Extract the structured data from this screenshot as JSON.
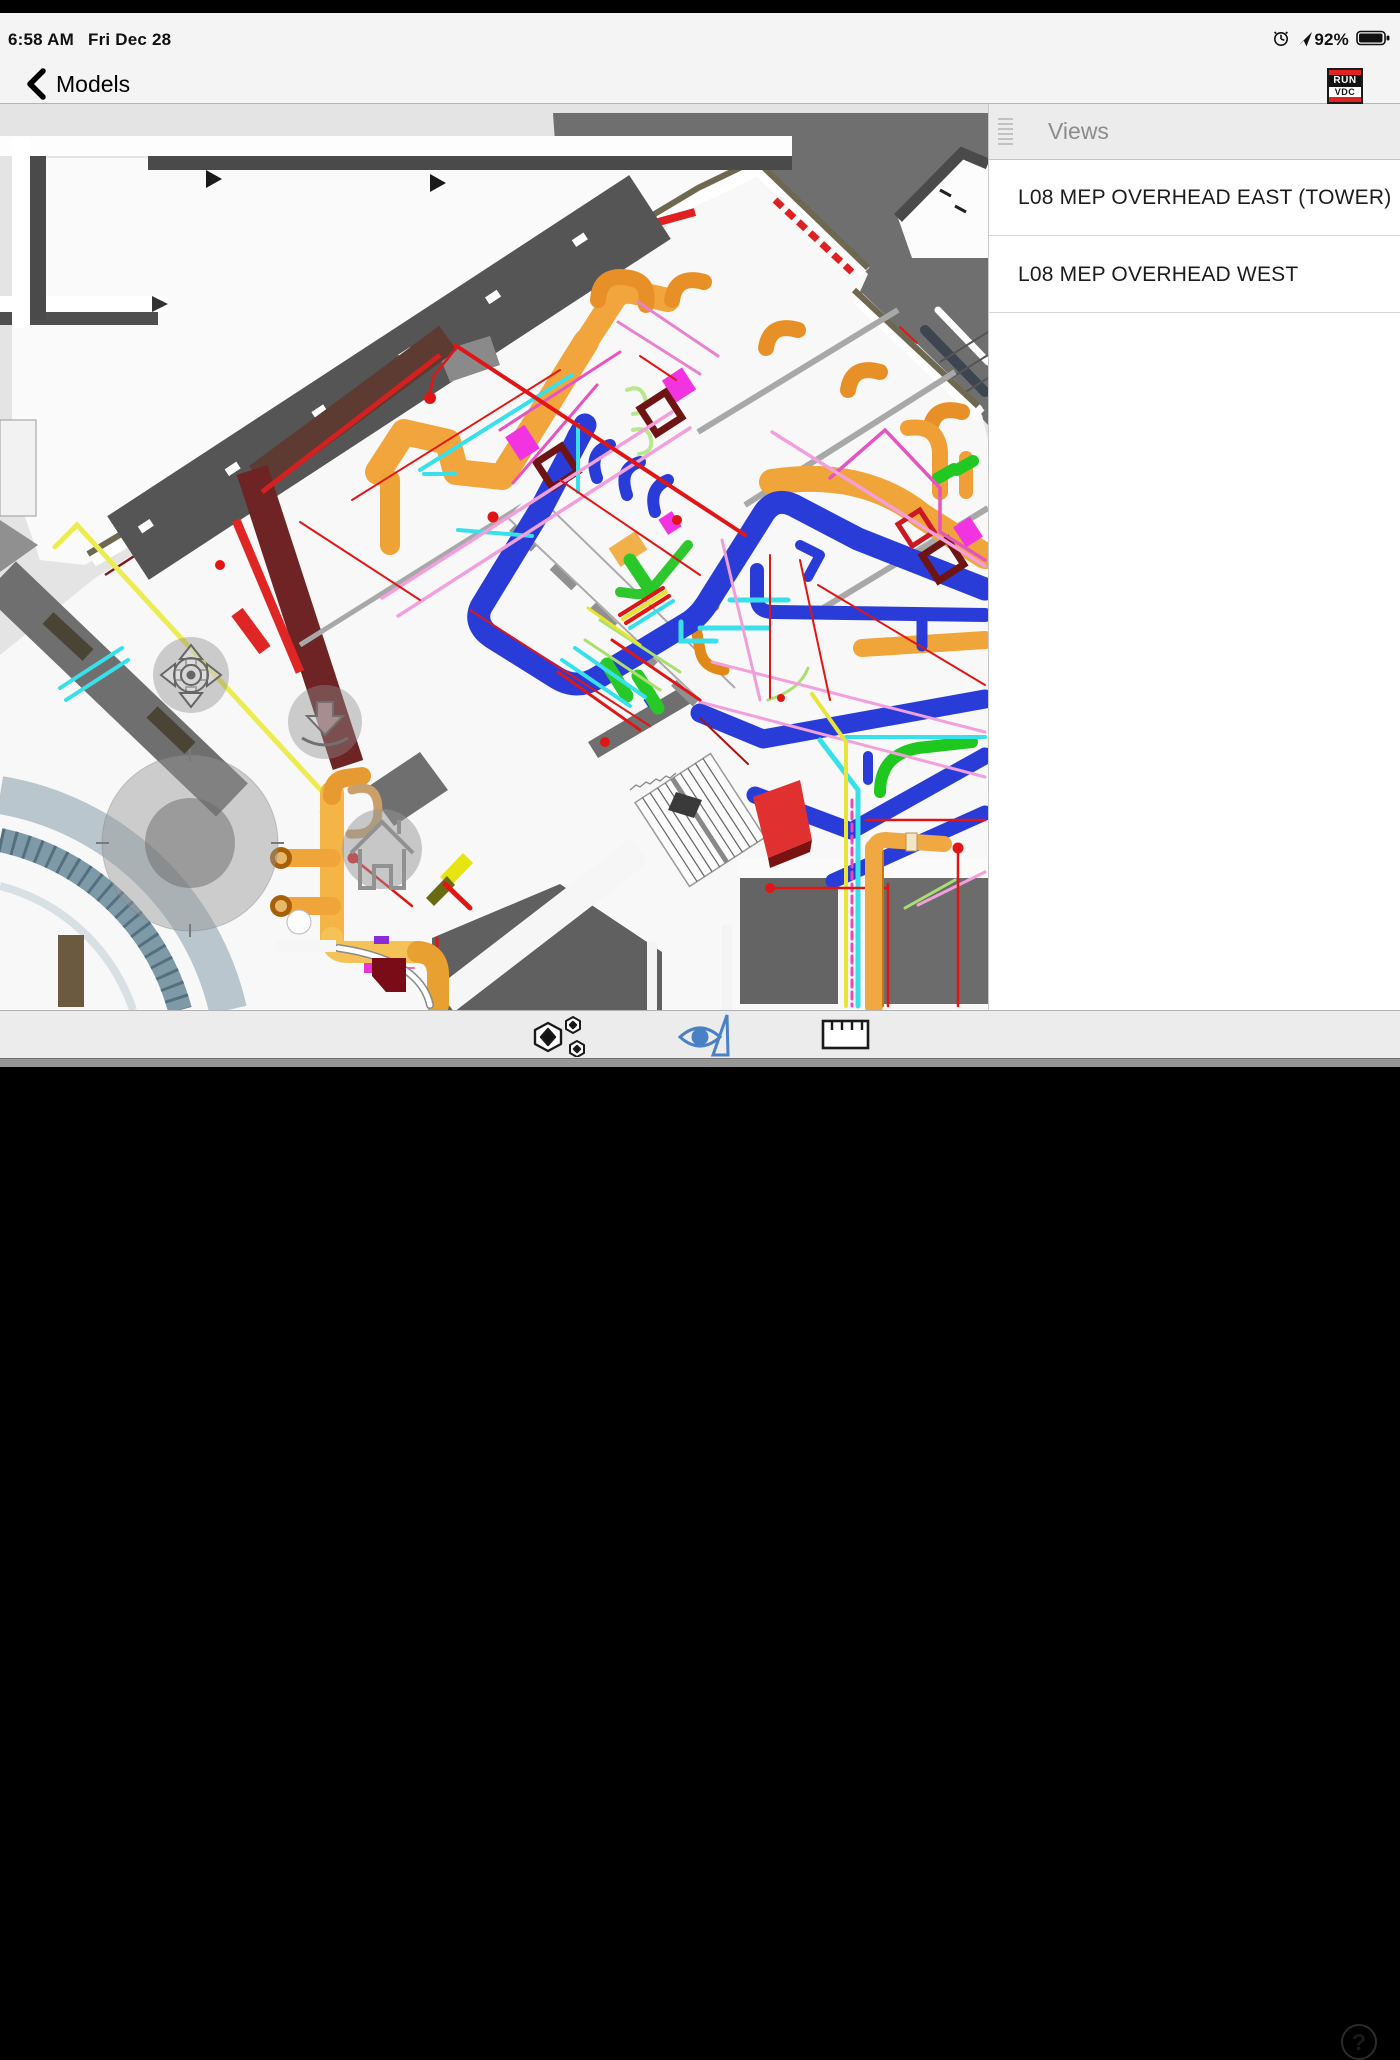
{
  "status_bar": {
    "time": "6:58 AM",
    "date": "Fri Dec 28",
    "battery_percent": "92%"
  },
  "nav_bar": {
    "back_label": "Models",
    "logo_line1": "RUN",
    "logo_line2": "VDC"
  },
  "sidebar": {
    "title": "Views",
    "items": [
      {
        "label": "L08 MEP OVERHEAD EAST (TOWER)"
      },
      {
        "label": "L08 MEP OVERHEAD WEST"
      }
    ]
  },
  "toolbar": {
    "help_label": "?"
  },
  "model_view": {
    "palette": {
      "accent_blue": "#4a80c4",
      "duct_orange": "#f2a53c",
      "pipe_blue": "#2a3cd8",
      "pipe_red": "#e01616",
      "pipe_cyan": "#38e0ea",
      "pipe_pink": "#f2a0dc",
      "pipe_magenta": "#f233e2",
      "pipe_green": "#2ec82e",
      "pipe_yellow": "#ecec52",
      "beam_maroon": "#6e2424",
      "beam_brown": "#5d3a32",
      "wall_olive": "#6f6850",
      "exterior_gray": "#6f6f6f"
    }
  }
}
